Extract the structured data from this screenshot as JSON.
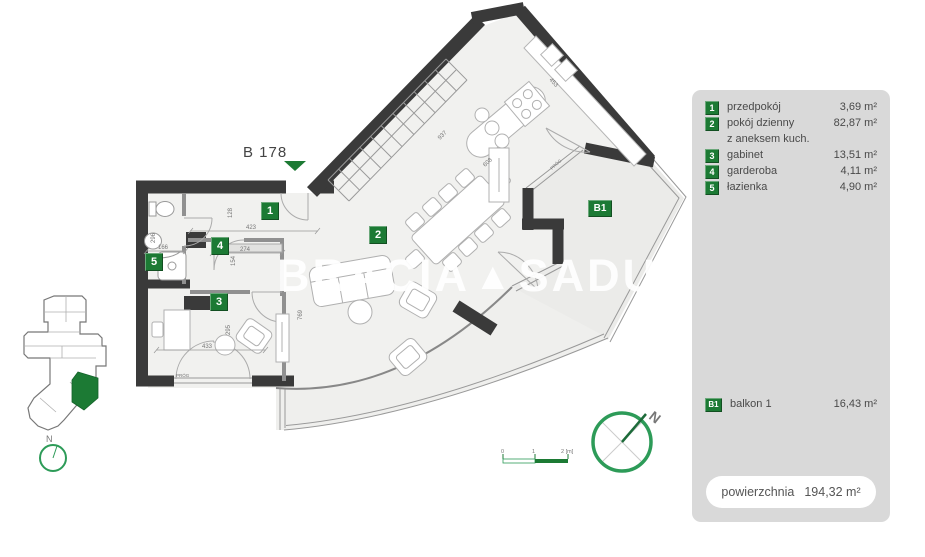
{
  "plan": {
    "unit_label": "B 178",
    "watermark": {
      "word1": "BRACIA",
      "logo": "▲",
      "word2": "SADURSCY"
    },
    "markers": {
      "m1": "1",
      "m2": "2",
      "m3": "3",
      "m4": "4",
      "m5": "5",
      "b1": "B1"
    },
    "dimensions": {
      "d423": "423",
      "d274": "274",
      "d166": "166",
      "d296": "296",
      "d128": "128",
      "d154": "154",
      "d433": "433",
      "d295": "295",
      "d769": "769",
      "d937": "937",
      "d453": "453",
      "d608": "608",
      "prog1": "PRÓG",
      "prog2": "PRÓG"
    }
  },
  "keyplan": {
    "north_label": "N"
  },
  "compass": {
    "north_label": "N"
  },
  "scalebar": {
    "tick0": "0",
    "tick1": "1",
    "tick2": "2 [m]"
  },
  "legend": {
    "items": [
      {
        "num": "1",
        "label": "przedpokój",
        "area": "3,69 m²"
      },
      {
        "num": "2",
        "label": "pokój dzienny",
        "label2": "z aneksem kuch.",
        "area": "82,87 m²"
      },
      {
        "num": "3",
        "label": "gabinet",
        "area": "13,51 m²"
      },
      {
        "num": "4",
        "label": "garderoba",
        "area": "4,11 m²"
      },
      {
        "num": "5",
        "label": "łazienka",
        "area": "4,90 m²"
      }
    ],
    "balcony": {
      "num": "B1",
      "label": "balkon 1",
      "area": "16,43 m²"
    },
    "total": {
      "label": "powierzchnia",
      "value": "194,32 m²"
    }
  },
  "colors": {
    "green": "#1c7a34",
    "wall": "#3a3a3a",
    "panel": "#d9d9d9"
  }
}
